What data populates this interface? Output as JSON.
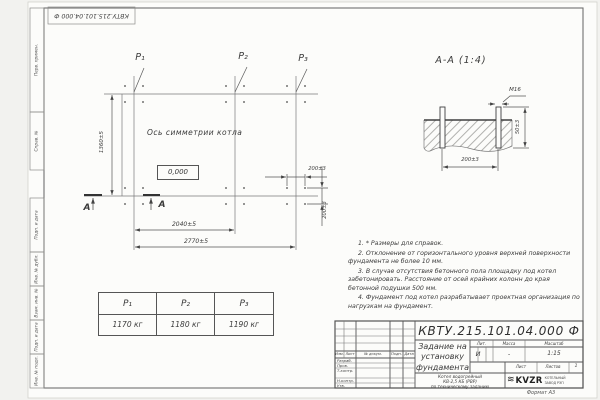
{
  "stamp": {
    "doc_number_top": "КВТУ.215.101.04.000 Ф",
    "format_note": "Формат А3"
  },
  "side_strip": {
    "labels": [
      "Перв. примен.",
      "Справ. №",
      "Подп. и дата",
      "Инв. № дубл.",
      "Взам. инв. №",
      "Подп. и дата",
      "Инв. № подл."
    ]
  },
  "plan": {
    "load_points": [
      "P₁",
      "P₂",
      "P₃"
    ],
    "axis_label": "Ось симметрии котла",
    "elevation_mark": "0,000",
    "dim_vertical": "1360±5",
    "dim_span_inner": "2040±5",
    "dim_span_outer": "2770±5",
    "dim_bolt_horizontal": "200±3",
    "dim_bolt_vertical": "200±3",
    "section_mark": "А"
  },
  "section_view": {
    "title": "А-А (1:4)",
    "bolt_thread": "М16",
    "dim_height": "50±3",
    "dim_spacing": "200±3"
  },
  "notes": [
    "1. * Размеры для справок.",
    "2. Отклонение от горизонтального уровня верхней поверхности фундамента не более 10 мм.",
    "3. В случае отсутствия бетонного пола площадку под котел забетонировать. Расстояние от осей крайних колонн до края бетонной подушки 500 мм.",
    "4. Фундамент под котел разрабатывает проектная организация по нагрузкам на фундамент."
  ],
  "load_table": {
    "headers": [
      "P₁",
      "P₂",
      "P₃"
    ],
    "values": [
      "1170 кг",
      "1180 кг",
      "1190 кг"
    ]
  },
  "title_block": {
    "doc_number": "КВТУ.215.101.04.000 Ф",
    "title_line1": "Задание на",
    "title_line2": "установку",
    "title_line3": "фундамента",
    "product_line1": "Котел водогрейный",
    "product_line2": "КВ-2,5 КБ (РВР)",
    "product_line3": "по техническому заданию",
    "col_izm": "Изм.",
    "col_list": "Лист",
    "col_doc": "№ докум.",
    "col_sign": "Подп.",
    "col_date": "Дата",
    "roles": [
      "Разраб.",
      "Пров.",
      "Т.контр.",
      "Н.контр.",
      "Утв."
    ],
    "lit_label": "Лит.",
    "mass_label": "Масса",
    "scale_label": "Масштаб",
    "lit_value": "И",
    "mass_value": "-",
    "scale_value": "1:15",
    "sheet_label": "Лист",
    "sheets_label": "Листов",
    "sheets_value": "1",
    "logo_text": "KVZR",
    "company_line1": "КОТЕЛЬНЫЙ",
    "company_line2": "ЗАВОД РЭП"
  }
}
